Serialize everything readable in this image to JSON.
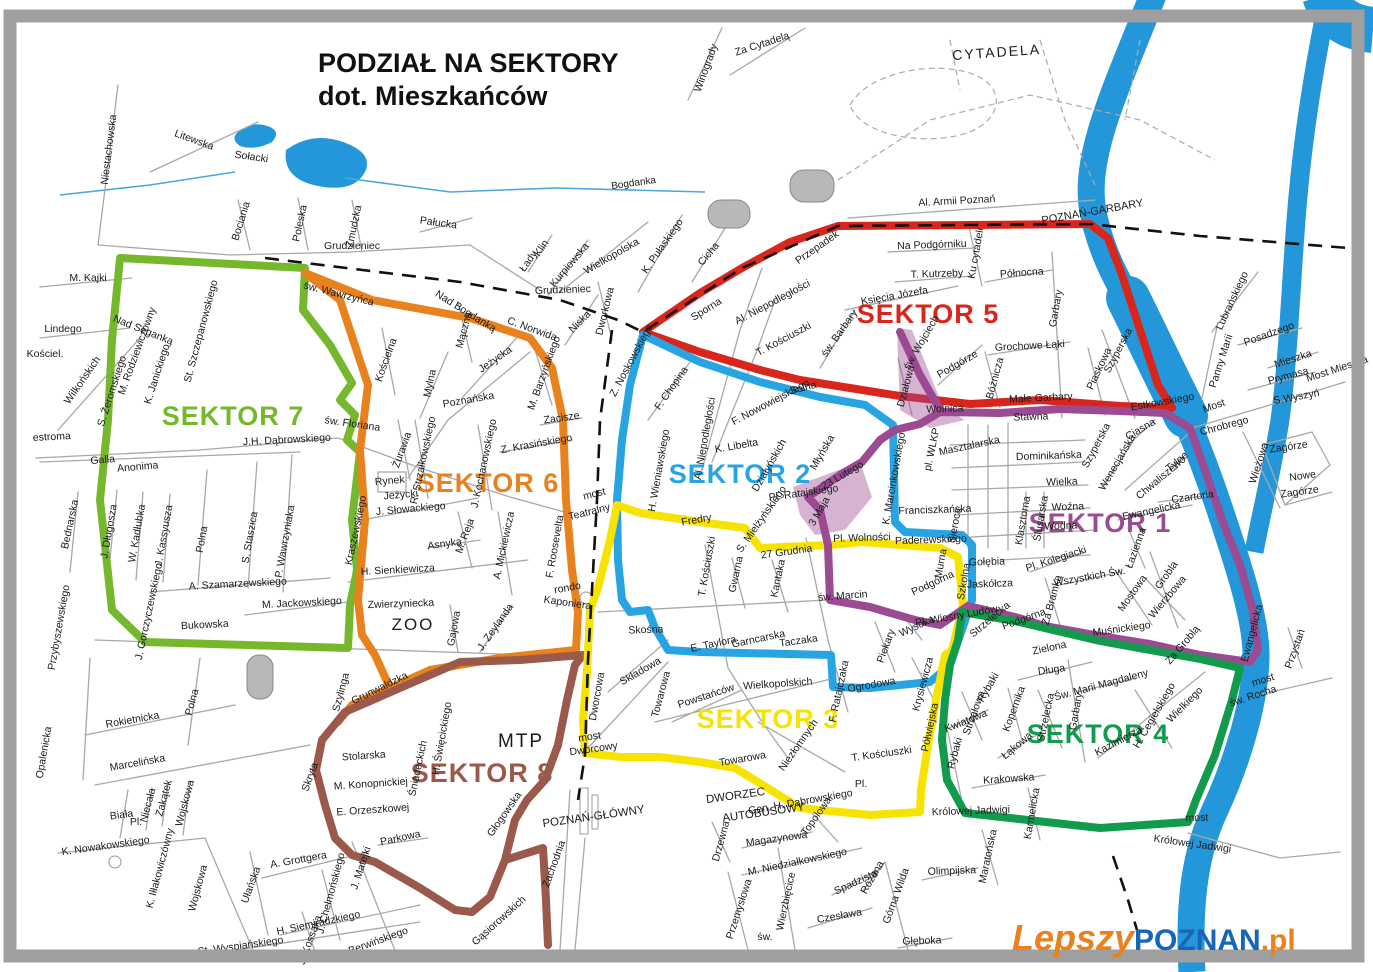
{
  "title": {
    "line1": "PODZIAŁ NA SEKTORY",
    "line2": "dot. Mieszkańców"
  },
  "sectors": {
    "s1": {
      "label": "SEKTOR 1",
      "color": "#9b4b92"
    },
    "s2": {
      "label": "SEKTOR 2",
      "color": "#29a4e2"
    },
    "s3": {
      "label": "SEKTOR 3",
      "color": "#f6e400"
    },
    "s4": {
      "label": "SEKTOR 4",
      "color": "#129b4c"
    },
    "s5": {
      "label": "SEKTOR 5",
      "color": "#d8261c"
    },
    "s6": {
      "label": "SEKTOR 6",
      "color": "#e8821f"
    },
    "s7": {
      "label": "SEKTOR 7",
      "color": "#76b82d"
    },
    "s8": {
      "label": "SEKTOR 8",
      "color": "#9a594a"
    }
  },
  "colors": {
    "water": "#2397d9",
    "rail_dash": "#111111"
  },
  "areas": {
    "cytadela": "CYTADELA",
    "zoo": "ZOO",
    "mtp": "MTP",
    "dworzec1": "DWORZEC",
    "dworzec2": "AUTOBUSOWY",
    "poznan_glowny": "POZNAŃ-GŁÓWNY",
    "poznan_garbary": "POZNAŃ-GARBARY",
    "bogdanka": "Bogdanka"
  },
  "watermark": {
    "part1": "Lepszy",
    "part2": "POZNAN",
    "part3": ".pl"
  },
  "labels": [
    "Niestachowska",
    "Litewska",
    "Sołacki",
    "Bociania",
    "Poleska",
    "Żmudzka",
    "Grudzieniec",
    "Pałucka",
    "M. Kajki",
    "Lindego",
    "Kościel.",
    "Wilkońskich",
    "S. Żeromskiego",
    "Nad Seganką",
    "M. Rodziewiczówny",
    "K. Janickiego",
    "St. Szczepanowskiego",
    "św. Wawrzyńca",
    "J.H. Dąbrowskiego",
    "estroma",
    "Galla",
    "Anonima",
    "Bednarska",
    "J. Długosza",
    "W. Kadłubka",
    "J. Kassyusza",
    "Polna",
    "S. Staszica",
    "P. Wawrzyniaka",
    "A. Szamarzewskiego",
    "M. Jackowskiego",
    "J. Gorczyczewskiego",
    "Bukowska",
    "Przybyszewskiego",
    "Rokietnicka",
    "Polna",
    "Marcelińska",
    "Opalenicka",
    "Biała",
    "Niecała",
    "Zakątek",
    "Wojskowa",
    "Pl.",
    "K. Nowakowskiego",
    "K. Iłłakowiczówny",
    "Wojskowa",
    "Ułańska",
    "A. Grottgera",
    "J. Matejki",
    "Parkowa",
    "J. Chełmońskiego",
    "H. Siemiradzkiego",
    "J. Kossaka",
    "R. Berwińskiego",
    "St. Wyspiańskiego",
    "Gąsiorowskich",
    "Szylinga",
    "Skryta",
    "Stolarska",
    "M. Konopnickiej",
    "E. Orzeszkowej",
    "Grunwaldzka",
    "Śniadeckich",
    "H. Święcickiego",
    "Zachodnia",
    "Głogowska",
    "Zwierzyniecka",
    "Gajowa",
    "J. Zeylanda",
    "Nad Bogdanką",
    "C. Norwida",
    "Mączna",
    "Kościelna",
    "Jeżycka",
    "Mylna",
    "Poznańska",
    "R. Strzałkowskiego",
    "M. Barzyńskiego",
    "Zacisze",
    "Z. Krasińskiego",
    "J. Kochanowskiego",
    "A. Mickiewicza",
    "M. Reja",
    "Asnyka",
    "Rynek",
    "Jeżycki",
    "J. Słowackiego",
    "Kraszewskiego",
    "Żurawia",
    "św. Floriana",
    "H. Sienkiewicza",
    "F. Roosevelta",
    "most",
    "Teatralny",
    "rondo",
    "Kaponiera",
    "Wielkopolska",
    "K. Pułaskiego",
    "Cicha",
    "Kurpiowska",
    "Łady",
    "Klin",
    "Grudzieniec",
    "Niska",
    "Dworkowa",
    "Z. Noskowskiego",
    "F. Chopina",
    "Sporna",
    "Przepadek",
    "Al. Niepodległości",
    "T. Kościuszki",
    "św. Barbary",
    "Księcia Józefa",
    "św. Wojciech",
    "Działowa",
    "Na Podgórniku",
    "T. Kutrzeby",
    "Ku cytadeli",
    "Północna",
    "Garbary",
    "Grochowe Łąki",
    "Podgórze",
    "Bóżnicza",
    "Małe Garbary",
    "Szyperska",
    "Piaskowa",
    "Estkowskiego",
    "Stawna",
    "Wolnica",
    "Solna",
    "F. Nowowiejskiego",
    "Al. Niepodległości",
    "K. Libelta",
    "Działyńskich",
    "Młyńska",
    "H. Wieniawskiego",
    "Fredry",
    "S. Mielżyńskiego",
    "27 Grudnia",
    "Pl. Wolności",
    "Pl. Ratajskiego",
    "3 Maja",
    "23 Lutego",
    "K. Marcinkowskiego",
    "pl. WLKP",
    "Masztalarska",
    "Franciszkańska",
    "Paderewskiego",
    "Sieroca",
    "Murna",
    "Szkolna",
    "Gołębia",
    "Jaskółcza",
    "Podgórna",
    "Gwarna",
    "Kantaka",
    "św. Marcin",
    "T. Kościuszki",
    "Piekary",
    "Wysoka",
    "Krysiewicza",
    "Pl. Wiosny Ludów",
    "Taczaka",
    "Garncarska",
    "E. Taylora",
    "Skośna",
    "Składowa",
    "Towarowa",
    "Powstańców",
    "Wielkopolskich",
    "Ogrodowa",
    "F. Ratajczaka",
    "Niezłomnych",
    "Towarowa",
    "T. Kościuszki",
    "Pl.",
    "Gen. H. Dąbrowskiego",
    "most",
    "Dworcowy",
    "Dworcowa",
    "Półwiejska",
    "Strzałowa",
    "Rybaki",
    "Kwiatowa",
    "Kopernika",
    "Łąkowa",
    "Rybaki",
    "Krakowska",
    "Królowej Jadwigi",
    "Karmelicka",
    "Maratońska",
    "Olimpijska",
    "Strzelecka",
    "Długa",
    "Strzelecka",
    "Garbary",
    "Św. Marii Magdaleny",
    "H. Cegielskiego",
    "Kazimierza",
    "Wielkiego",
    "most",
    "św. Rocha",
    "Przystań",
    "Królowej Jadwigi",
    "most",
    "Dominikańska",
    "Wielka",
    "Woźna",
    "Wodna",
    "Klasztorna",
    "Ślusarska",
    "Pl. Kolegiacki",
    "Za Bramką",
    "Wszystkich Św.",
    "Mostowa",
    "Wierzbowa",
    "Grobla",
    "Łazienna",
    "Ewangelicka",
    "Czartoria",
    "Tylne",
    "Chwaliszewo",
    "Wenecjańska",
    "Ciasna",
    "Szyperska",
    "Muśnickiego",
    "Zielona",
    "Podgórna",
    "Za Groblą",
    "Ewangelicka",
    "Zagórze",
    "Nowe",
    "Zagórze",
    "Wieżowa",
    "Panny Marii",
    "Lubrańskiego",
    "Posadzego",
    "Mieszka",
    "Prymasa",
    "Most Mieszka",
    "S.Wyszyń",
    "Most",
    "Chrobrego",
    "Winogrady",
    "Za Cytadelą",
    "Al. Armii Poznań",
    "Wierzbięcice",
    "Przemysłowa",
    "M. Niedziałkowskiego",
    "Magazynowa",
    "Topolowa",
    "Drzewna",
    "Różana",
    "Spadzista",
    "Czesława",
    "Górna Wilda",
    "Głęboka",
    "św."
  ]
}
